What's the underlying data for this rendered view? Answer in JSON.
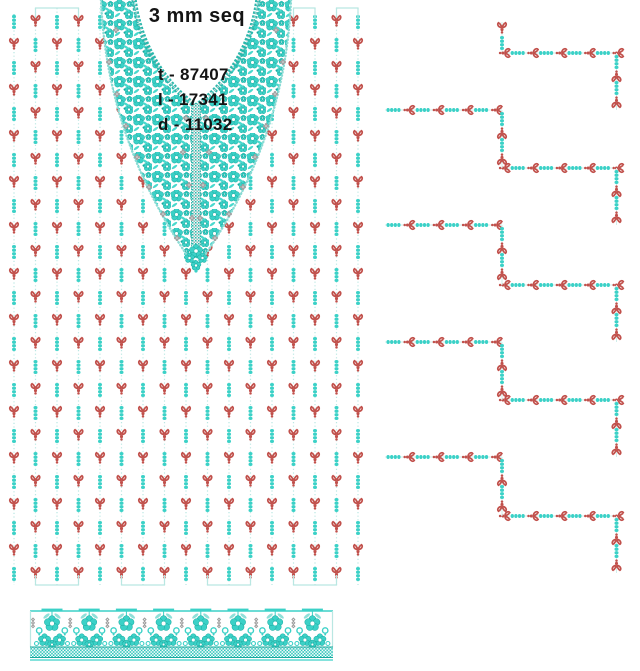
{
  "text_block": {
    "title": "3 mm seq",
    "stats": [
      "t - 87407",
      "l - 17341",
      "d - 11032"
    ]
  },
  "colors": {
    "teal": "#3bd1c7",
    "teal_mid": "#49d8cd",
    "teal_dark": "#17a89d",
    "teal_chain": "#2bb7ac",
    "teal_pale": "#b9e7e2",
    "red": "#c1504b",
    "gray": "#9c9c9c",
    "gray_light": "#c9c9c9",
    "text": "#141414",
    "white": "#ffffff"
  },
  "pattern": {
    "canvas": {
      "width": 640,
      "height": 671
    },
    "columns": {
      "count": 17,
      "x0": 14,
      "dx": 21.5,
      "line_top": 8,
      "line_bottom": 585,
      "row_y0": 22,
      "row_dy": 23,
      "rows": 25,
      "top_brackets": [
        [
          35.5,
          78.5
        ],
        [
          293.5,
          315
        ],
        [
          336.5,
          358
        ]
      ],
      "bottom_brackets": [
        [
          35.5,
          78.5
        ],
        [
          121.5,
          164.5
        ],
        [
          207.5,
          250.5
        ],
        [
          293.5,
          336.5
        ]
      ]
    },
    "collar": {
      "outer_left": 101,
      "outer_right": 291,
      "inner_left": 134,
      "inner_right": 258,
      "cx": 196,
      "tip_y": 268,
      "inner_tip_y": 106,
      "placket": {
        "x": 191.5,
        "w": 9,
        "y1": 104,
        "y2": 246
      },
      "gray_accents": [
        [
          116,
          30
        ],
        [
          109,
          62
        ],
        [
          117,
          94
        ],
        [
          126,
          126
        ],
        [
          137,
          157
        ],
        [
          149,
          187
        ],
        [
          163,
          214
        ],
        [
          177,
          238
        ],
        [
          276,
          30
        ],
        [
          283,
          62
        ],
        [
          275,
          94
        ],
        [
          266,
          126
        ],
        [
          255,
          157
        ],
        [
          243,
          187
        ],
        [
          229,
          214
        ],
        [
          215,
          238
        ],
        [
          186,
          118
        ],
        [
          206,
          118
        ],
        [
          183,
          152
        ],
        [
          209,
          152
        ],
        [
          189,
          185
        ],
        [
          203,
          185
        ],
        [
          192,
          218
        ],
        [
          200,
          218
        ]
      ]
    },
    "staircase": {
      "x_left": 385,
      "x_mid": 502,
      "x_right": 616.5,
      "h_right_y": [
        53,
        168,
        285,
        400,
        516
      ],
      "h_left_y": [
        110,
        225,
        342,
        457
      ],
      "stub_top": 22,
      "tail_bottom": 573
    },
    "strip": {
      "x1": 30,
      "x2": 333,
      "line_y": 611,
      "band_y": 647.5,
      "band_h": 9.5,
      "cluster_x0": 52,
      "cluster_dx": 37.2,
      "clusters": 8,
      "gray_x0": 33
    }
  }
}
